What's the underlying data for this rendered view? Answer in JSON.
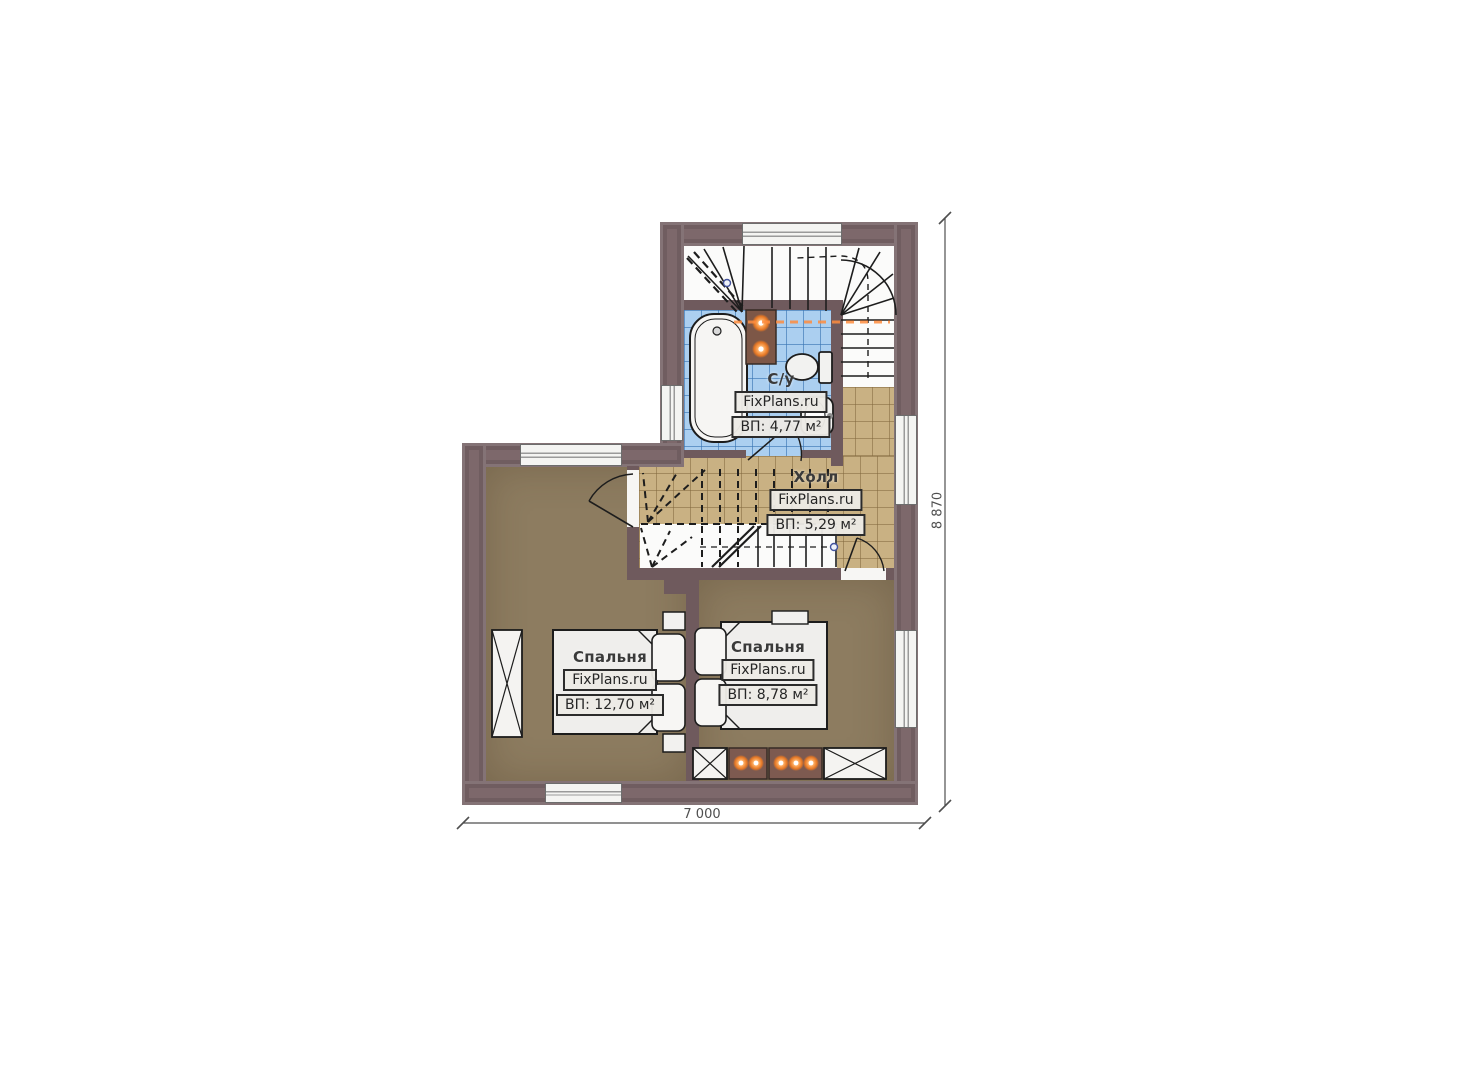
{
  "plan": {
    "title": "Floor plan — second floor",
    "rooms": {
      "bathroom": {
        "name": "С/у",
        "watermark": "FixPlans.ru",
        "area": "ВП: 4,77 м²"
      },
      "hall": {
        "name": "Холл",
        "watermark": "FixPlans.ru",
        "area": "ВП: 5,29 м²"
      },
      "bedroom_left": {
        "name": "Спальня",
        "watermark": "FixPlans.ru",
        "area": "ВП: 12,70 м²"
      },
      "bedroom_right": {
        "name": "Спальня",
        "watermark": "FixPlans.ru",
        "area": "ВП: 8,78 м²"
      }
    },
    "dimensions": {
      "width_label": "7 000",
      "height_label": "8 870"
    },
    "colors": {
      "wall": "#7d686b",
      "bedroom_floor": "#8d7c60",
      "hall_tile": "#c9b183",
      "bath_tile": "#abcff0",
      "accent_glow": "#ff8d3f",
      "furniture_brown": "#7d5a50"
    }
  }
}
